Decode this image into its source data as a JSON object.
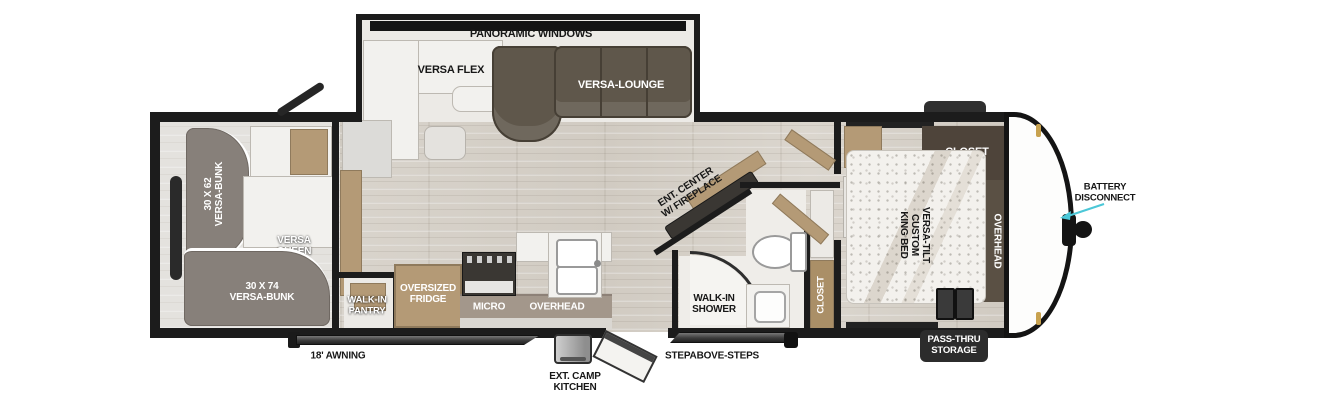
{
  "colors": {
    "wall": "#1c1c1c",
    "wood_floor": "#d6d1c9",
    "tan_wood": "#b49a76",
    "sofa_brown": "#5f574b",
    "bunk_gray": "#87807a",
    "closet_brown": "#4e443a",
    "overhead_band": "#a3978b",
    "arrow_cyan": "#4bc7d7"
  },
  "slide_out": {
    "panoramic_windows": "PANORAMIC WINDOWS",
    "versa_flex": "VERSA FLEX",
    "versa_lounge": "VERSA-LOUNGE"
  },
  "bunk_room": {
    "bunk_62_size": "30 X 62",
    "bunk_62_name": "VERSA-BUNK",
    "queen_line1": "VERSA",
    "queen_line2": "QUEEN",
    "bunk_74_size": "30 X 74",
    "bunk_74_name": "VERSA-BUNK"
  },
  "kitchen": {
    "pantry_line1": "WALK-IN",
    "pantry_line2": "PANTRY",
    "fridge_line1": "OVERSIZED",
    "fridge_line2": "FRIDGE",
    "micro": "MICRO",
    "overhead": "OVERHEAD"
  },
  "living": {
    "ent_center_line1": "ENT. CENTER",
    "ent_center_line2": "W/ FIREPLACE"
  },
  "bathroom": {
    "shower_line1": "WALK-IN",
    "shower_line2": "SHOWER",
    "closet": "CLOSET"
  },
  "bedroom": {
    "closet": "CLOSET",
    "overhead": "OVERHEAD",
    "bed_line1": "VERSA-TILT",
    "bed_line2": "CUSTOM",
    "bed_line3": "KING BED"
  },
  "exterior": {
    "battery_line1": "BATTERY",
    "battery_line2": "DISCONNECT",
    "awning": "18' AWNING",
    "camp_kitchen_line1": "EXT. CAMP",
    "camp_kitchen_line2": "KITCHEN",
    "steps": "STEPABOVE-STEPS",
    "pass_thru_line1": "PASS-THRU",
    "pass_thru_line2": "STORAGE"
  }
}
